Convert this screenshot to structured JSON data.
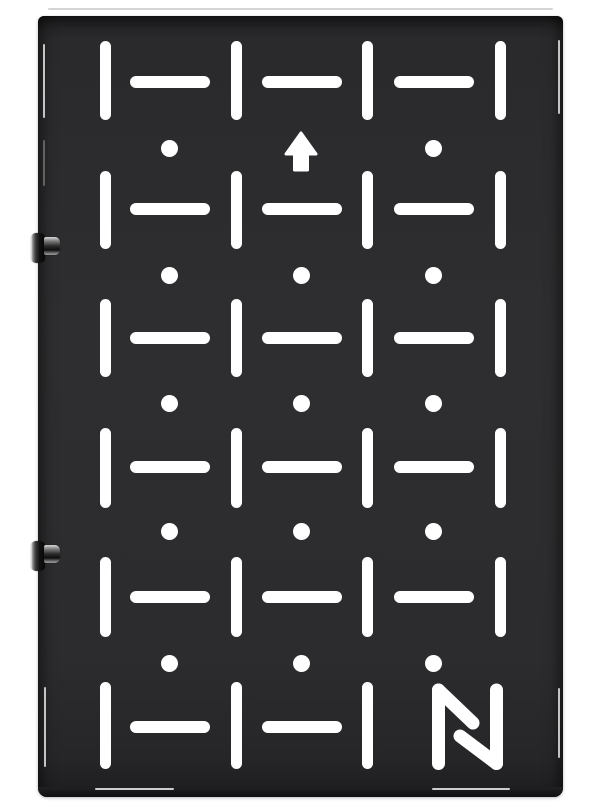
{
  "scene": {
    "background_color": "#ffffff",
    "panel": {
      "x": 38,
      "y": 16,
      "width": 525,
      "height": 781,
      "surface_color": "#2c2c2e",
      "bottom_edge_color": "#161618",
      "cutout_color": "#ffffff"
    },
    "grid": {
      "vslot": {
        "width": 11,
        "cols_x": [
          100,
          231,
          362,
          495
        ],
        "rows": [
          {
            "y": 41,
            "h": 79
          },
          {
            "y": 171,
            "h": 78
          },
          {
            "y": 299,
            "h": 78
          },
          {
            "y": 428,
            "h": 80
          },
          {
            "y": 557,
            "h": 80
          },
          {
            "y": 682,
            "h": 87
          }
        ],
        "skip": [
          "5,3"
        ]
      },
      "hslot": {
        "height": 12,
        "length": 80,
        "cols_x": [
          130,
          262,
          394
        ],
        "rows_y": [
          76,
          203,
          332,
          461,
          591,
          721
        ],
        "skip": [
          "5,2"
        ]
      },
      "hole": {
        "diameter": 17,
        "cols_x": [
          169,
          301,
          433
        ],
        "rows_y": [
          148,
          275,
          403,
          531,
          663
        ],
        "skip": [
          "0,1"
        ]
      }
    },
    "arrow": {
      "direction": "up",
      "x": 284,
      "y": 131,
      "width": 34,
      "height": 41
    },
    "logo": {
      "letter": "N",
      "x": 425,
      "y": 676,
      "width": 90,
      "height": 100,
      "stroke_width": 13
    },
    "bolts": [
      {
        "head": {
          "x": 31,
          "y": 233,
          "w": 14,
          "h": 30
        },
        "pin": {
          "x": 44,
          "y": 237,
          "w": 16,
          "h": 18
        }
      },
      {
        "head": {
          "x": 31,
          "y": 541,
          "w": 14,
          "h": 30
        },
        "pin": {
          "x": 44,
          "y": 545,
          "w": 16,
          "h": 18
        }
      }
    ],
    "highlights": [
      {
        "x": 43,
        "y": 44,
        "w": 2,
        "h": 74,
        "o": 0.9
      },
      {
        "x": 43,
        "y": 140,
        "w": 2,
        "h": 46,
        "o": 0.35
      },
      {
        "x": 44,
        "y": 687,
        "w": 2,
        "h": 80,
        "o": 0.9
      },
      {
        "x": 558,
        "y": 40,
        "w": 2,
        "h": 74,
        "o": 0.9
      },
      {
        "x": 558,
        "y": 688,
        "w": 2,
        "h": 70,
        "o": 0.9
      },
      {
        "x": 95,
        "y": 788,
        "w": 79,
        "h": 2,
        "o": 0.95
      },
      {
        "x": 432,
        "y": 788,
        "w": 78,
        "h": 2,
        "o": 0.95
      }
    ],
    "top_hairline": {
      "x": 48,
      "y": 8,
      "w": 505,
      "h": 2
    }
  }
}
